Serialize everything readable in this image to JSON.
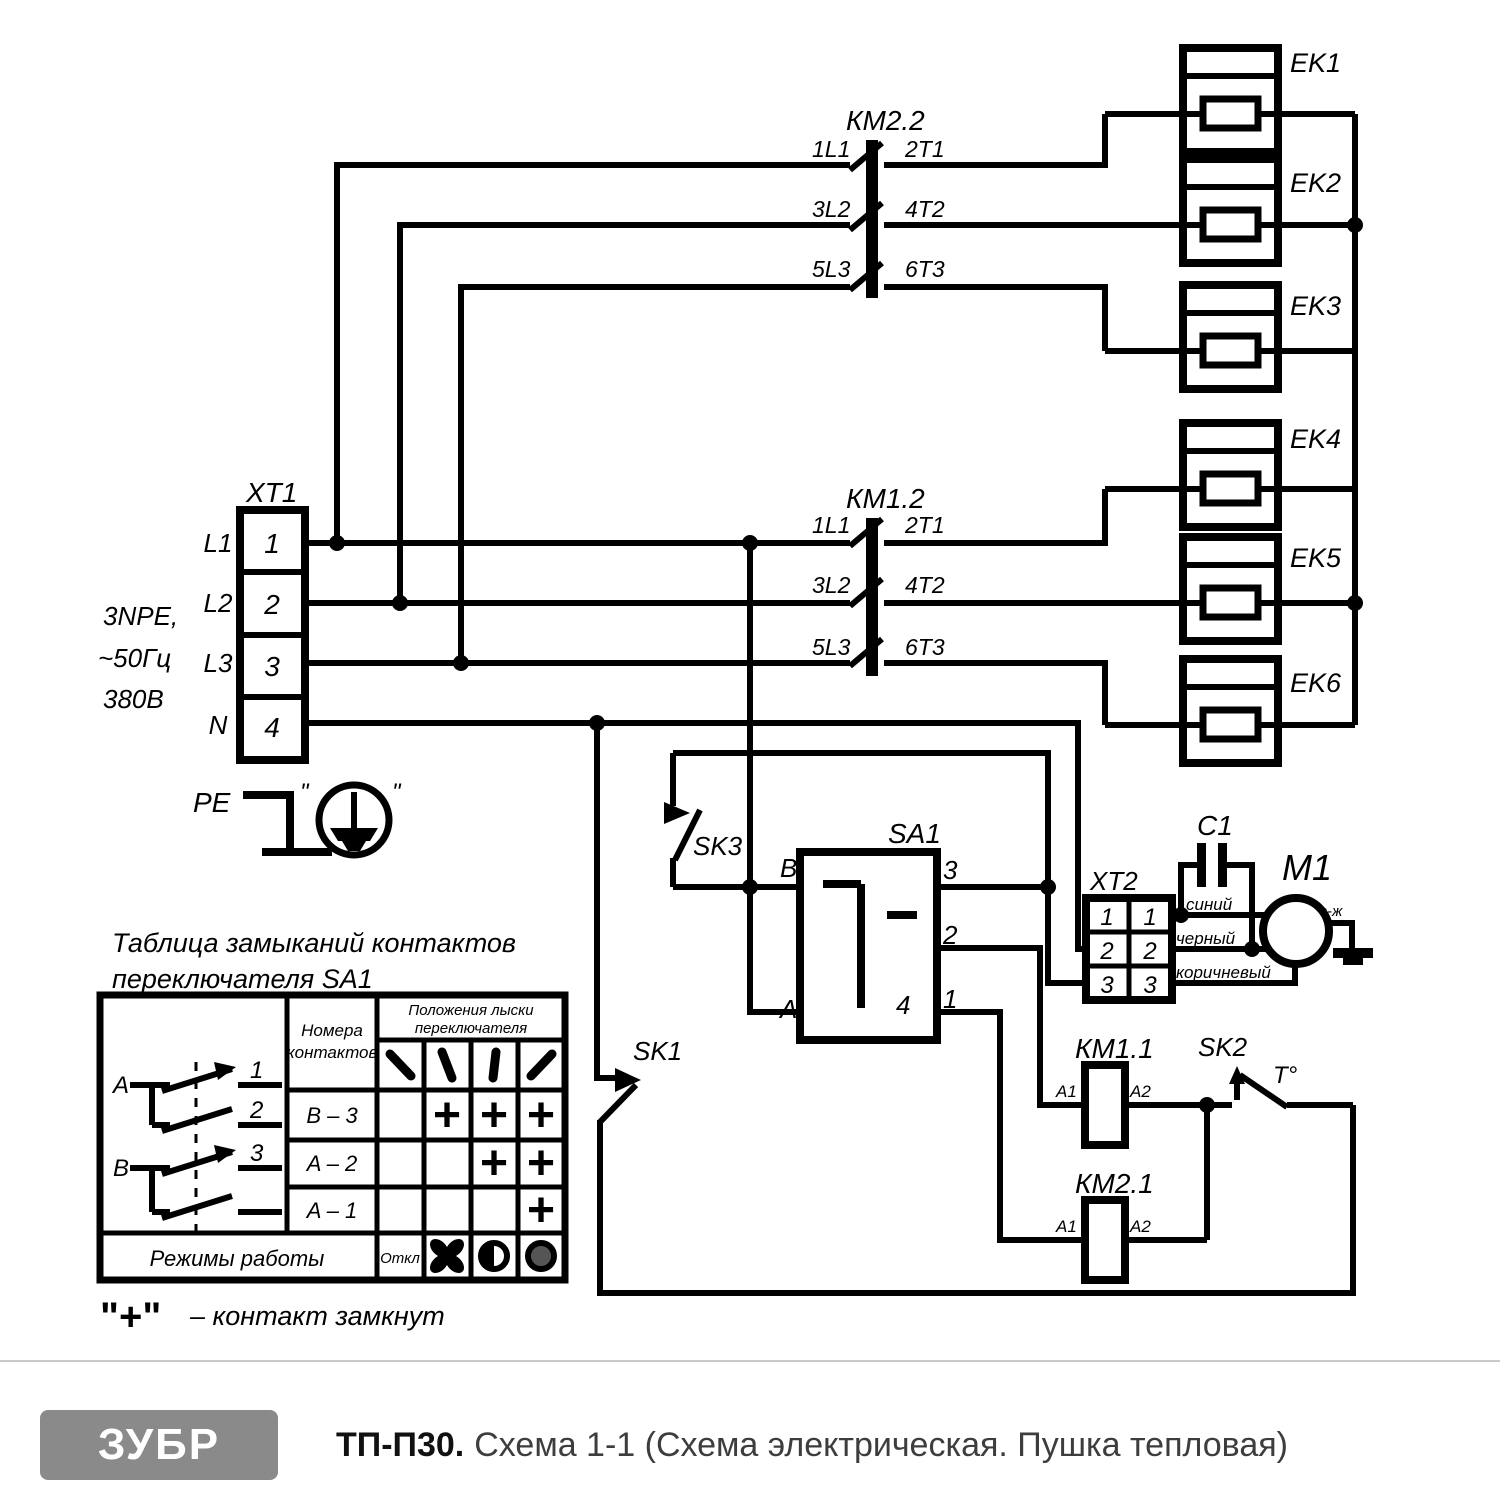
{
  "supply": {
    "block_label": "XT1",
    "terminals": [
      "1",
      "2",
      "3",
      "4"
    ],
    "phases": [
      "L1",
      "L2",
      "L3",
      "N"
    ],
    "spec": [
      "3NPE,",
      "~50Гц",
      "380В"
    ],
    "pe": "PE",
    "earth_quote": "\""
  },
  "contactors": {
    "km22": {
      "label": "КМ2.2",
      "p": [
        [
          "1L1",
          "2T1"
        ],
        [
          "3L2",
          "4T2"
        ],
        [
          "5L3",
          "6T3"
        ]
      ]
    },
    "km12": {
      "label": "КМ1.2",
      "p": [
        [
          "1L1",
          "2T1"
        ],
        [
          "3L2",
          "4T2"
        ],
        [
          "5L3",
          "6T3"
        ]
      ]
    },
    "km11": {
      "label": "КМ1.1",
      "a1": "A1",
      "a2": "A2"
    },
    "km21": {
      "label": "КМ2.1",
      "a1": "A1",
      "a2": "A2"
    }
  },
  "heaters": [
    "EK1",
    "EK2",
    "EK3",
    "EK4",
    "EK5",
    "EK6"
  ],
  "switches": {
    "sk1": "SK1",
    "sk2": "SK2",
    "sk2_t": "T°",
    "sk3": "SK3"
  },
  "selector": {
    "label": "SA1",
    "b": "B",
    "a": "A",
    "o3": "3",
    "o2": "2",
    "o1": "1",
    "o4": "4"
  },
  "xt2": {
    "label": "XT2",
    "l": [
      "1",
      "2",
      "3"
    ],
    "r": [
      "1",
      "2",
      "3"
    ]
  },
  "motor": {
    "label": "M1",
    "cap": "C1",
    "wire_blue": "синий",
    "wire_black": "черный",
    "wire_brown": "коричневый",
    "wire_ground": "з-ж"
  },
  "table": {
    "title1": "Таблица замыканий контактов",
    "title2": "переключателя SA1",
    "col_contacts1": "Номера",
    "col_contacts2": "контактов",
    "col_positions1": "Положения лыски",
    "col_positions2": "переключателя",
    "rows": [
      {
        "name": "B – 3",
        "m": [
          "",
          "+",
          "+",
          "+"
        ]
      },
      {
        "name": "A – 2",
        "m": [
          "",
          "",
          "+",
          "+"
        ]
      },
      {
        "name": "A – 1",
        "m": [
          "",
          "",
          "",
          "+"
        ]
      }
    ],
    "modes": "Режимы работы",
    "off": "Откл",
    "diag": {
      "a": "A",
      "b": "B",
      "n1": "1",
      "n2": "2",
      "n3": "3"
    },
    "legend_plus": "\"+\"",
    "legend_text": "– контакт замкнут"
  },
  "footer": {
    "brand": "ЗУБР",
    "model": "ТП-П30.",
    "caption": "Схема 1-1 (Схема электрическая. Пушка тепловая)"
  }
}
